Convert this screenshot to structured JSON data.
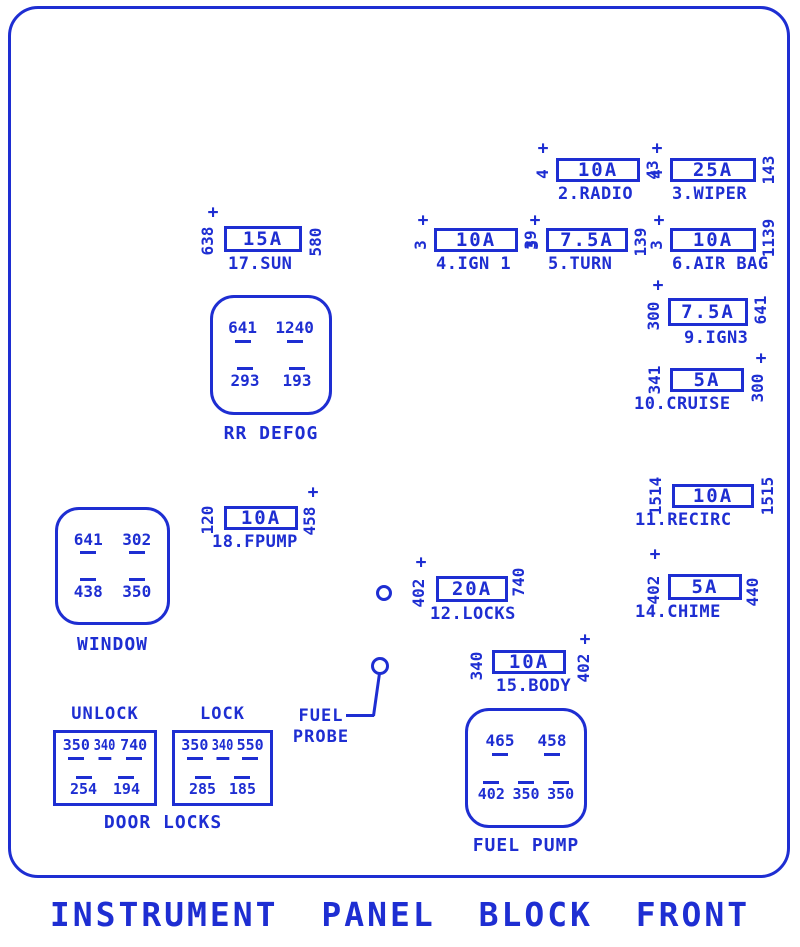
{
  "title": "INSTRUMENT PANEL BLOCK FRONT",
  "colors": {
    "ink": "#1e2ed2",
    "background": "#ffffff"
  },
  "symbols": {
    "plus": "+"
  },
  "fuses": [
    {
      "amp": "10A",
      "label": "2.RADIO",
      "left_wire": "4",
      "right_wire": "43"
    },
    {
      "amp": "25A",
      "label": "3.WIPER",
      "left_wire": "4",
      "right_wire": "143"
    },
    {
      "amp": "10A",
      "label": "4.IGN 1",
      "left_wire": "3",
      "right_wire": "39"
    },
    {
      "amp": "7.5A",
      "label": "5.TURN",
      "left_wire": "3",
      "right_wire": "139"
    },
    {
      "amp": "10A",
      "label": "6.AIR BAG",
      "left_wire": "3",
      "right_wire": "1139"
    },
    {
      "amp": "15A",
      "label": "17.SUN",
      "left_wire": "638",
      "right_wire": "580"
    },
    {
      "amp": "7.5A",
      "label": "9.IGN3",
      "left_wire": "300",
      "right_wire": "641"
    },
    {
      "amp": "5A",
      "label": "10.CRUISE",
      "left_wire": "341",
      "right_wire": "300"
    },
    {
      "amp": "10A",
      "label": "11.RECIRC",
      "left_wire": "1514",
      "right_wire": "1515"
    },
    {
      "amp": "5A",
      "label": "14.CHIME",
      "left_wire": "402",
      "right_wire": "440"
    },
    {
      "amp": "10A",
      "label": "18.FPUMP",
      "left_wire": "120",
      "right_wire": "458"
    },
    {
      "amp": "20A",
      "label": "12.LOCKS",
      "left_wire": "402",
      "right_wire": "740"
    },
    {
      "amp": "10A",
      "label": "15.BODY",
      "left_wire": "340",
      "right_wire": "402"
    }
  ],
  "relays": {
    "rr_defog": {
      "label": "RR DEFOG",
      "pins_top": [
        "641",
        "1240"
      ],
      "pins_bottom": [
        "293",
        "193"
      ]
    },
    "window": {
      "label": "WINDOW",
      "pins_top": [
        "641",
        "302"
      ],
      "pins_bottom": [
        "438",
        "350"
      ]
    },
    "fuel_pump": {
      "label": "FUEL PUMP",
      "pins_top": [
        "465",
        "458"
      ],
      "pins_bottom": [
        "402",
        "350",
        "350"
      ]
    }
  },
  "door_locks": {
    "label": "DOOR LOCKS",
    "unlock": {
      "label": "UNLOCK",
      "pins_top": [
        "350",
        "340",
        "740"
      ],
      "pins_bottom": [
        "254",
        "194"
      ]
    },
    "lock": {
      "label": "LOCK",
      "pins_top": [
        "350",
        "340",
        "550"
      ],
      "pins_bottom": [
        "285",
        "185"
      ]
    }
  },
  "fuel_probe": {
    "line1": "FUEL",
    "line2": "PROBE"
  }
}
